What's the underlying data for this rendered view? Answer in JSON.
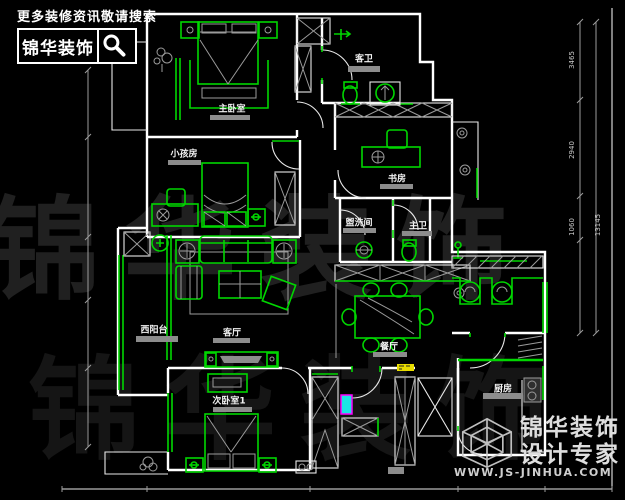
{
  "branding": {
    "search_prompt": "更多装修资讯敬请搜索",
    "logo_text": "锦华装饰",
    "bg_watermark": "锦华装饰"
  },
  "watermark": {
    "company": "锦华装饰",
    "tagline": "设计专家",
    "website": "WWW.JS-JINHUA.COM"
  },
  "rooms": {
    "master_bedroom": "主卧室",
    "guest_bath": "客卫",
    "study": "书房",
    "kids_room": "小孩房",
    "washroom": "盥洗间",
    "master_bath": "主卫",
    "living_room": "客厅",
    "west_balcony": "西阳台",
    "dining_room": "餐厅",
    "bedroom_1": "次卧室1",
    "kitchen": "厨房"
  },
  "dimensions": {
    "right_segments": [
      "3465",
      "2940",
      "1060"
    ],
    "right_total": "13145"
  },
  "colors": {
    "background": "#000000",
    "walls": "#ffffff",
    "furniture_green": "#00d600",
    "detail_gray": "#9b9b9b",
    "highlight_yellow": "#e8dc00",
    "highlight_cyan": "#19e5e5",
    "highlight_magenta": "#ff00ff"
  }
}
